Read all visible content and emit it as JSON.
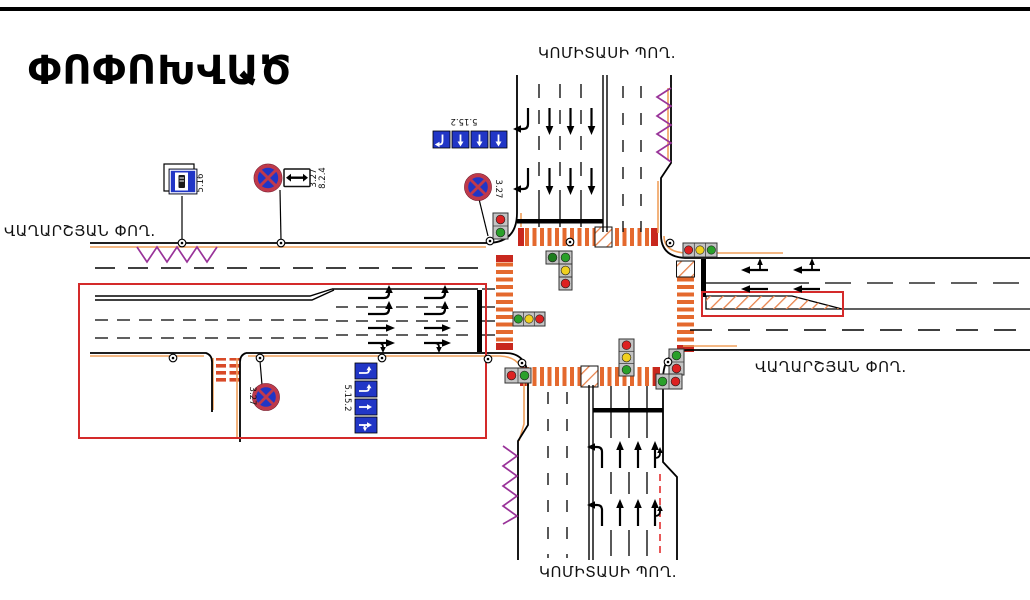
{
  "title": "ՓՈՓՈԽՎԱԾ",
  "streets": {
    "north": "ԿՈՄԻՏԱՍԻ ՊՈՂ.",
    "south": "ԿՈՄԻՏԱՍԻ ՊՈՂ.",
    "west": "ՎԱՂԱՐՇՅԱՆ ՓՈՂ.",
    "east": "ՎԱՂԱՐՇՅԱՆ ՓՈՂ."
  },
  "sign_codes": {
    "bus_stop": "5.16",
    "no_stopping": "3.27",
    "zone_extent_plate": "8.2.4",
    "lane_directions": "5.15.2"
  },
  "colors": {
    "crosswalk_orange": "#E4692E",
    "curb_offset_orange": "#F0A05C",
    "bus_zone_purple": "#993399",
    "highlight_red": "#D42A2A",
    "sign_blue": "#2136C6",
    "no_stopping_ring": "#C0394B",
    "signal_red": "#DD2222",
    "signal_yellow": "#F0D020",
    "signal_green": "#2AA02A"
  }
}
